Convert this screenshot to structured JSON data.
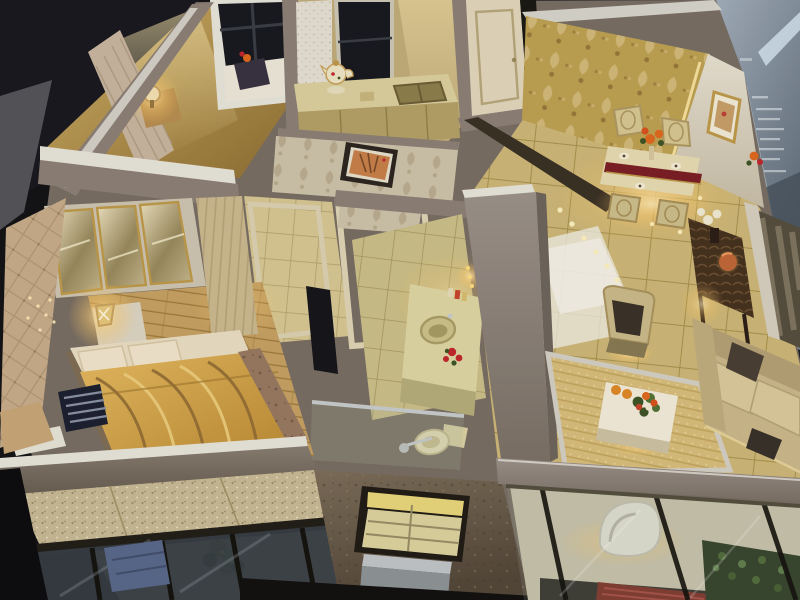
{
  "scene": {
    "kind": "photograph-of-architectural-scale-model",
    "labels": {
      "root": "photo of a miniature apartment scale model viewed from above",
      "background": "dark showroom background",
      "display_case": "glass display case with faint etched signage",
      "model_base": "apartment model base slab",
      "second_bedroom": "second bedroom with daybed, lamp and bed by the window",
      "kitchen": "kitchen with counter, teapot, sink and window",
      "entry_door": "cream entry door slightly ajar",
      "dining_room": "dining room with golden damask feature wall",
      "dining_set": "dining table with runner, flowers and four chairs",
      "living_room": "living room with glossy tile floor",
      "sofa": "cream sofa with dark cushions",
      "armchair": "gilded armchair with dark cushion",
      "coffee_table": "white coffee table with flower bouquet and oranges",
      "rug": "gold woven area rug",
      "console_table": "carved dark-wood console with white flowers and copper lamp",
      "mirror_wall": "mirrored TV feature wall",
      "corridor": "tiled corridor with door frames",
      "bathroom": "bathroom with vanity, round sink, red flowers and toilet",
      "master_bedroom": "master bedroom",
      "wardrobe": "mirrored three-door wardrobe with gold trim",
      "bed": "bed with golden striped duvet and striped dark pillow",
      "nightstand_lamp": "nightstand with glowing crystal lamp",
      "padded_wall": "tufted padded accent wall",
      "balcony_left": "bedroom balcony with granite floor, plant and glass sliding doors",
      "exterior_wall": "textured exterior wall with glass-block window and metal box",
      "balcony_right": "living-room balcony with glass doors, white lounge chair and hedge",
      "artwork_interior": "framed orange artwork on beige damask wall",
      "artwork_dining": "gold framed artwork on white panel wall",
      "led_dots": "string of tiny LED lights on the floor",
      "teapot": "white porcelain teapot on kitchen counter"
    }
  },
  "colors": {
    "bg": "#141417",
    "bgDeep": "#0e0e10",
    "displayGray": "#56565a",
    "glass1": "#a8b4c0",
    "glass2": "#5a6673",
    "glassBar": "#d4e4ee",
    "glassText": "#eef3f7",
    "wallTop": "#8d8077",
    "wallTopLight": "#9d938b",
    "wallTrim": "#e9e5db",
    "wallFace": "#6f655c",
    "goldWallA": "#d4b36a",
    "goldWallB": "#8f6f33",
    "damask": "#bfa253",
    "damaskLite": "#d9c081",
    "damaskShadow": "#97793a",
    "beigeWall": "#cfc3aa",
    "beigeMotif": "#b9ab8d",
    "tile": "#cfb878",
    "tileGrout": "#a8934e",
    "tileSheen": "#f2efe4",
    "bathTile": "#cdc08a",
    "bathGrout": "#a89a62",
    "wood": "#c7a263",
    "woodLine": "#9f7b3e",
    "duvetA": "#e8bc62",
    "duvetB": "#b8862f",
    "duvetDark": "#8f6a34",
    "duvetLite": "#f0d080",
    "sheet": "#ebdfc4",
    "pillowDark": "#1e2230",
    "pillowStripe": "#8a92a4",
    "throwDark": "#9a7a62",
    "mirrorA": "#efe4c0",
    "mirrorB": "#9a8a5e",
    "goldTrim": "#bf9b4a",
    "cream": "#e3d8bc",
    "creamDark": "#b9a87c",
    "sofa": "#cdb98c",
    "sofaLite": "#dbca9c",
    "sofaDark": "#b6a276",
    "rug": "#d9bf7d",
    "rugLine": "#c2a55c",
    "rugBorder": "#d6d1c5",
    "consoleWood": "#46321f",
    "consoleCarve": "#6e5134",
    "copper": "#c1683a",
    "glow": "#ffe2a0",
    "led": "#fff2c0",
    "red": "#c2282e",
    "orange": "#e06a20",
    "orangeFruit": "#e08a28",
    "green": "#3f5626",
    "greenLite": "#55733a",
    "greenDark": "#26331a",
    "blueCushion": "#5a6a8c",
    "granite": "#c9bb95",
    "graniteDot": "#8a7c5a",
    "glassDoor": "#394046",
    "glassFrame": "#16140f",
    "glassReflect": "#9aa4ac",
    "silver": "#c2c6c8",
    "silverDark": "#8f9496",
    "exteriorA": "#7d6f5a",
    "exteriorB": "#55483a",
    "glassBlock": "#ded4a0",
    "windowDark": "#191b20",
    "runner": "#7c2026"
  }
}
